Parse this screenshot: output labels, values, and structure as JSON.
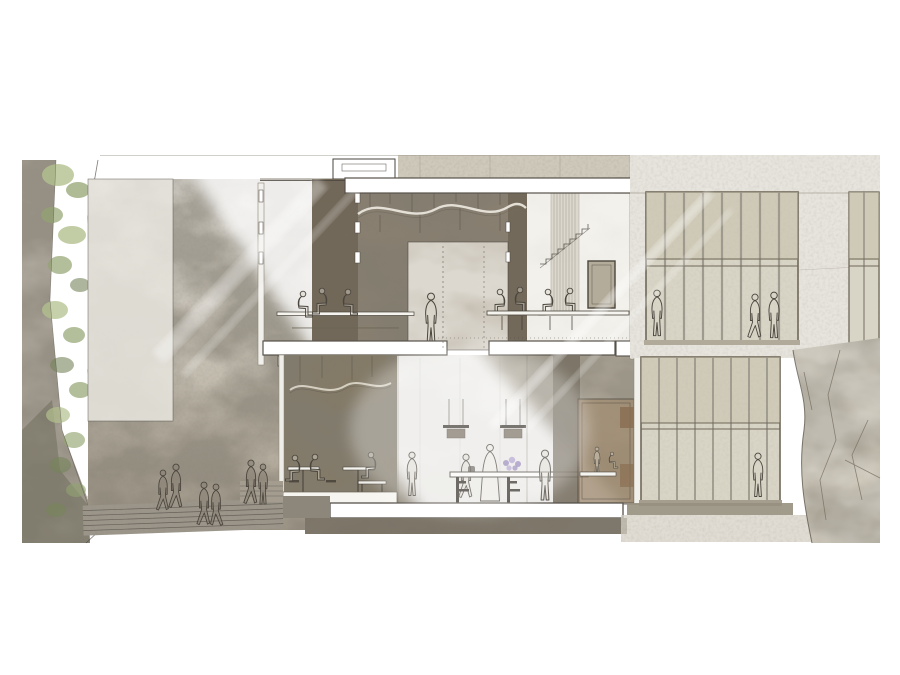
{
  "artwork": {
    "kind": "architectural-cross-section-rendering",
    "floors": 2,
    "figures": {
      "upper_floor": 10,
      "lower_floor": 10,
      "plaza_outside": 6
    },
    "features": {
      "wavy_ceiling_sculptures": 2,
      "pendant_lamps": 2,
      "curtain_wall_windows": 3,
      "exterior_stairs": true,
      "vegetated_cliff_left": true,
      "rock_face_right": true,
      "light_beam_diagonal": true,
      "rooftop_skylight_box": 1,
      "flower_bouquet_on_counter": 1
    }
  },
  "colors": {
    "paper": "#ffffff",
    "ink": "#4a453d",
    "slab": "#ffffff",
    "slabline": "#57524a",
    "figfill": "#d9d4c8",
    "wall-top": "#e4e1da",
    "wall-mid": "#cfc9be",
    "wall-low": "#a89f8f",
    "room": "#8a8071",
    "room-deep": "#6e6455",
    "room-lower": "#847a66",
    "fascia": "#cfc9bb",
    "facade": "#e7e4dd",
    "glass": "#d9d5c6",
    "glass-tan": "#c6bfa9",
    "mullion": "#9a958a",
    "rock": "#c8c1b2",
    "rock-shadow": "#9b9284",
    "stairs": "#9b958a",
    "plinth": "#7b7366",
    "veg-light": "#b3c18f",
    "veg": "#93a471",
    "veg-dark": "#76865а",
    "veg-deep": "#76865a",
    "flower": "#8f7fb5",
    "flower-light": "#ab9ccb",
    "wood": "#8a6f52"
  }
}
